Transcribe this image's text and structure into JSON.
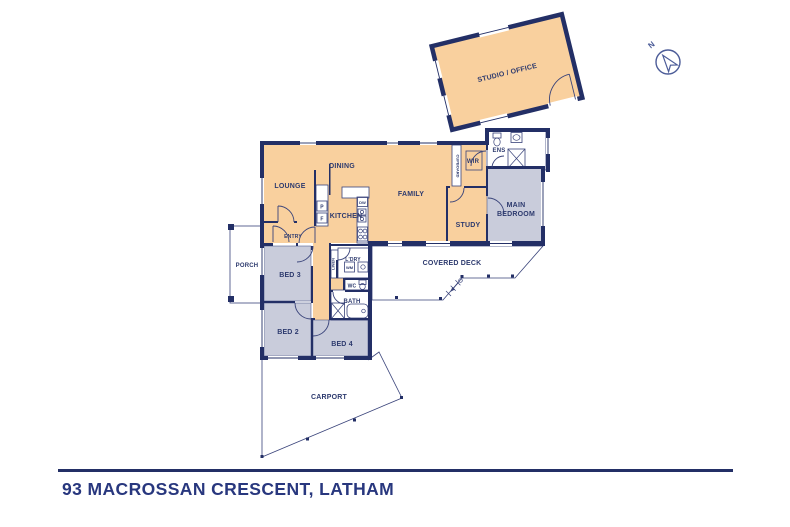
{
  "title": "93 MACROSSAN CRESCENT, LATHAM",
  "compass": {
    "north": "N"
  },
  "rooms": {
    "studio_office": "STUDIO / OFFICE",
    "lounge": "LOUNGE",
    "dining": "DINING",
    "kitchen": "KITCHEN",
    "family": "FAMILY",
    "cupboard": "CUPBOARD",
    "wir": "WIR",
    "ens": "ENS",
    "main_bedroom_l1": "MAIN",
    "main_bedroom_l2": "BEDROOM",
    "study": "STUDY",
    "entry": "ENTRY",
    "porch": "PORCH",
    "bed3": "BED 3",
    "bed2": "BED 2",
    "bed4": "BED 4",
    "linen": "LINEN",
    "laundry": "L'DRY",
    "wc": "WC",
    "bath": "BATH",
    "covered_deck": "COVERED DECK",
    "carport": "CARPORT"
  },
  "fixtures": {
    "pantry": "P",
    "fridge": "F",
    "dishwasher": "DW",
    "washing_machine": "WM"
  },
  "colors": {
    "wall": "#232F66",
    "living": "#F9D09E",
    "bedroom": "#C9CCDB",
    "hatch": "#97A2C6",
    "tile": "#AAB2CE",
    "text": "#2D3A6E",
    "title": "#28377E",
    "compass": "#4C5C98",
    "outline": "#39437A"
  }
}
